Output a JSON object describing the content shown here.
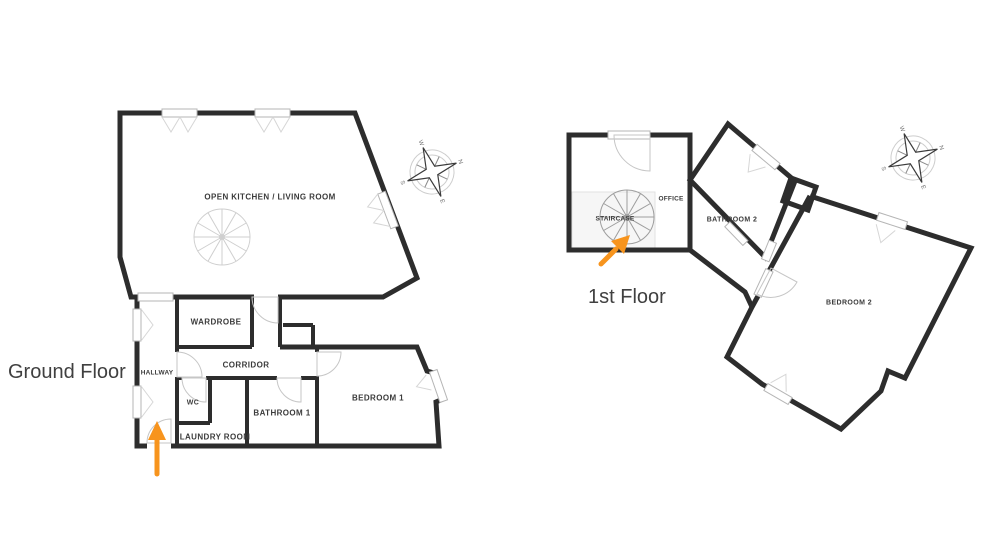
{
  "titles": {
    "ground": "Ground Floor",
    "first": "1st Floor"
  },
  "ground": {
    "rooms": {
      "kitchen": "OPEN KITCHEN / LIVING ROOM",
      "wardrobe": "WARDROBE",
      "hallway": "HALLWAY",
      "corridor": "CORRIDOR",
      "wc": "WC",
      "bathroom1": "BATHROOM 1",
      "laundry": "LAUNDRY ROOM",
      "bedroom1": "BEDROOM 1"
    }
  },
  "first": {
    "rooms": {
      "staircase": "STAIRCASE",
      "office": "OFFICE",
      "bathroom2": "BATHROOM 2",
      "bedroom2": "BEDROOM 2"
    }
  },
  "compass": {
    "north": "N",
    "east": "E",
    "south": "S",
    "west": "W"
  },
  "colors": {
    "wall": "#2d2d2d",
    "thin_lines": "#c6c6c6",
    "arrow": "#f7941d",
    "label_text": "#3b3b3b",
    "background": "#ffffff"
  }
}
